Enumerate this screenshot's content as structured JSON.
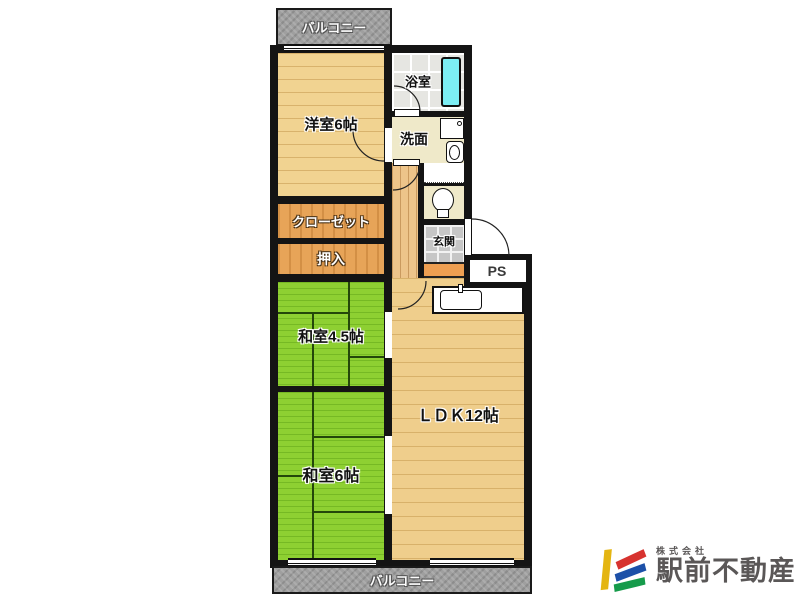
{
  "floorplan": {
    "balcony_top": "バルコニー",
    "balcony_bottom": "バルコニー",
    "rooms": {
      "western_room": "洋室6帖",
      "closet": "クローゼット",
      "oshiire": "押入",
      "japanese_room_45": "和室4.5帖",
      "japanese_room_6": "和室6帖",
      "ldk": "ＬＤＫ12帖",
      "bathroom": "浴室",
      "washroom": "洗面",
      "entrance": "玄関",
      "pipe_space": "PS"
    },
    "colors": {
      "tatami_green": "#8ed032",
      "wood_floor": "#f1d391",
      "closet_wood": "#e7a458",
      "balcony_gray": "#9f9f9f",
      "bathtub_cyan": "#7ceef4",
      "entrance_step_orange": "#ee9f52",
      "entrance_tile_gray": "#c6c6c6",
      "wall_black": "#141414"
    }
  },
  "branding": {
    "company_prefix": "株式会社",
    "company_name": "駅前不動産",
    "logo_colors": {
      "yellow": "#e4b512",
      "red": "#d7332f",
      "blue": "#1c50a8",
      "green": "#169b4b"
    }
  }
}
